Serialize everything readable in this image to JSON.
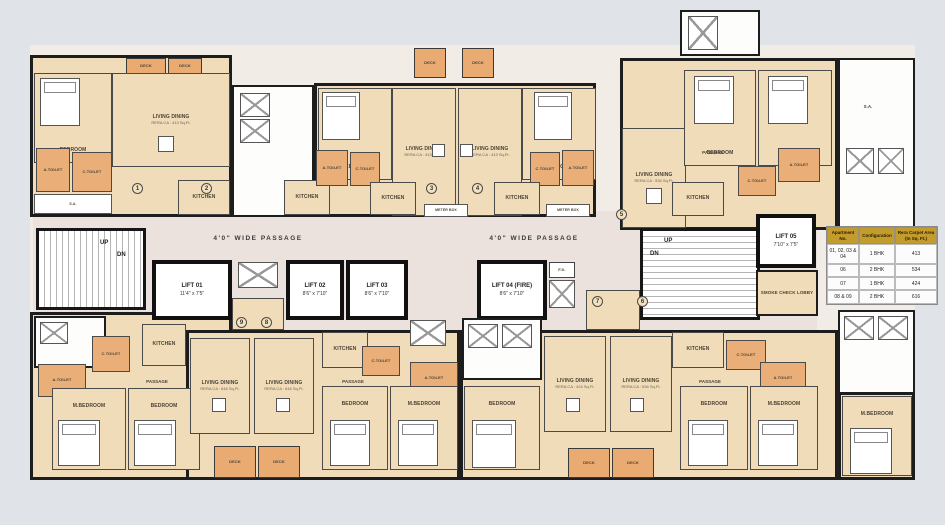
{
  "labels": {
    "bedroom": "BEDROOM",
    "m_bedroom": "M.BEDROOM",
    "living_dining": "LIVING DINING",
    "kitchen": "KITCHEN",
    "a_toilet": "A.TOILET",
    "c_toilet": "C.TOILET",
    "passage": "PASSAGE",
    "deck": "DECK",
    "sa": "S.A.",
    "fd": "F.D.",
    "meter_box": "METER BOX",
    "up": "UP",
    "dn": "DN",
    "wide_passage": "4'0\" WIDE PASSAGE",
    "smoke_lobby": "SMOKE CHECK LOBBY"
  },
  "rera": {
    "r413": "RERA CA : 413 Sq.Ft.",
    "r424": "RERA CA : 424 Sq.Ft.",
    "r534": "RERA CA : 534 Sq.Ft.",
    "r616": "RERA CA : 616 Sq.Ft."
  },
  "lifts": [
    {
      "name": "LIFT 01",
      "size": "11'4\" x 7'5\""
    },
    {
      "name": "LIFT 02",
      "size": "8'6\" x 7'10\""
    },
    {
      "name": "LIFT 03",
      "size": "8'6\" x 7'10\""
    },
    {
      "name": "LIFT 04 (FIRE)",
      "size": "8'6\" x 7'10\""
    },
    {
      "name": "LIFT 05",
      "size": "7'10\" x 7'5\""
    }
  ],
  "units": [
    "1",
    "2",
    "3",
    "4",
    "5",
    "6",
    "7",
    "8",
    "9"
  ],
  "table": {
    "headers": [
      "Apartment No.",
      "Configuration",
      "Rera Carpet Area (In Sq. Ft.)"
    ],
    "rows": [
      [
        "01, 02, 03 & 04",
        "1 BHK",
        "413"
      ],
      [
        "06",
        "2 BHK",
        "534"
      ],
      [
        "07",
        "1 BHK",
        "424"
      ],
      [
        "08 & 09",
        "2 BHK",
        "616"
      ]
    ]
  },
  "colors": {
    "background": "#e0e4e8",
    "wall": "#1d1d1d",
    "room_fill": "#f0dcb8",
    "accent_orange": "#eaaf78",
    "corridor_fill": "#ebe2dd",
    "core_fill": "#ffffff",
    "table_header": "#c49b2d"
  }
}
